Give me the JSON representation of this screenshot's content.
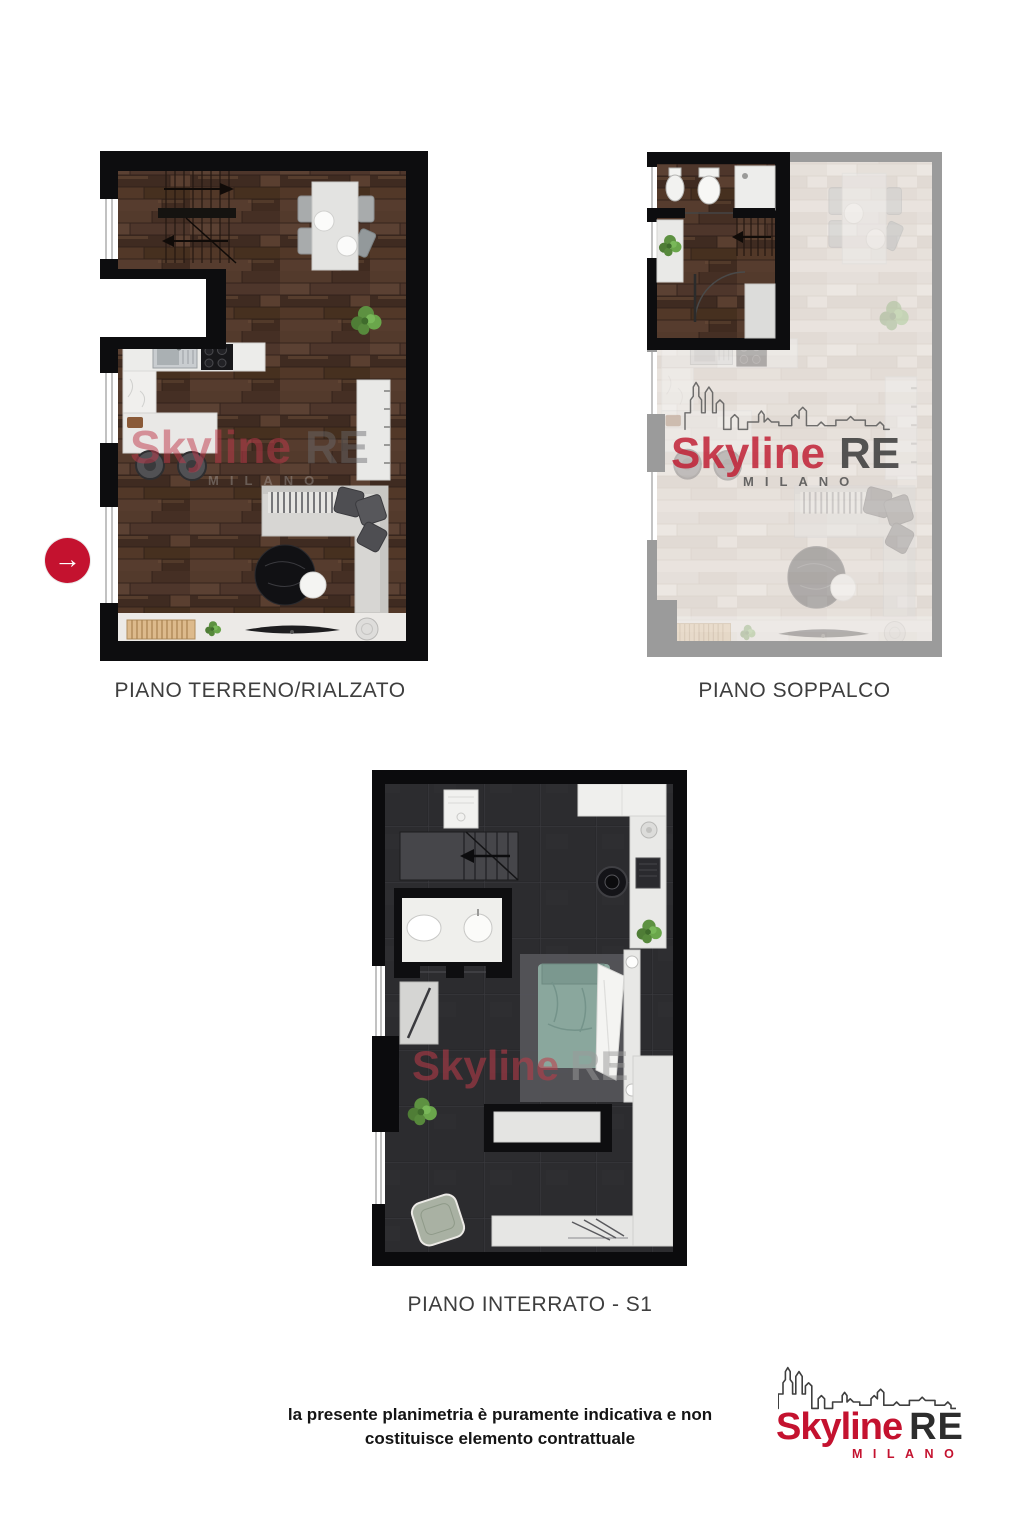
{
  "marker": {
    "icon": "arrow-right",
    "glyph": "→"
  },
  "plans": [
    {
      "label": "PIANO TERRENO/RIALZATO"
    },
    {
      "label": "PIANO SOPPALCO"
    },
    {
      "label": "PIANO INTERRATO - S1"
    }
  ],
  "watermark": {
    "brand": "Skyline",
    "suffix": "RE",
    "city": "MILANO"
  },
  "disclaimer": {
    "line1": "la presente planimetria è puramente indicativa e non",
    "line2": "costituisce elemento contrattuale"
  },
  "logo": {
    "brand": "Skyline",
    "suffix": "RE",
    "city": "MILANO"
  },
  "colors": {
    "accent_red": "#c4122f",
    "watermark_red": "#c0394b",
    "logo_dark": "#2d2d2d"
  }
}
